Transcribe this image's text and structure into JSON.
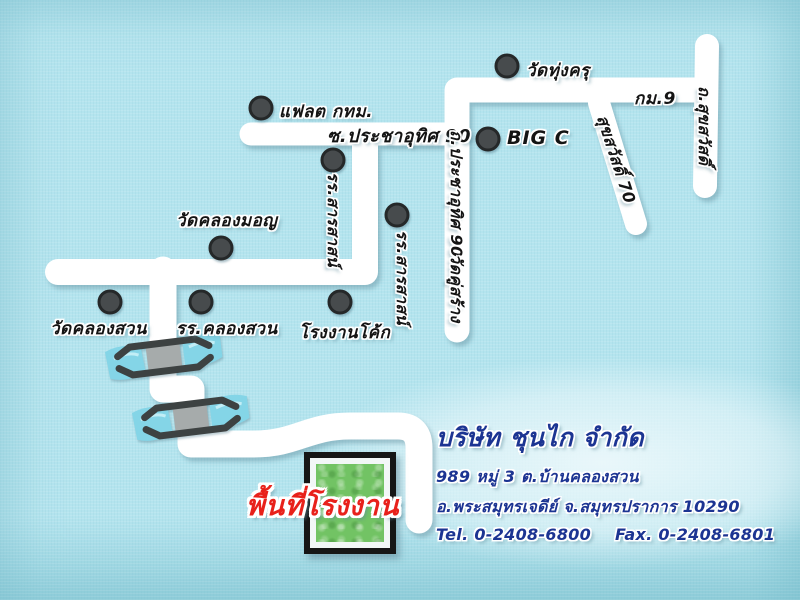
{
  "map": {
    "colors": {
      "background": "#b4e4ee",
      "road": "#ffffff",
      "dot": "#474b4d",
      "water": "#84d5e7",
      "factory_green": "#72c364",
      "factory_label_red": "#e8211b",
      "company_text_blue": "#1c3492"
    },
    "landmarks": [
      {
        "id": "flat-bangkok",
        "label": "แฟลต กทม."
      },
      {
        "id": "wat-thung-khru",
        "label": "วัดทุ่งครุ"
      },
      {
        "id": "big-c",
        "label": "BIG C"
      },
      {
        "id": "sarasas-school-west",
        "label": "รร.สารสาสน์"
      },
      {
        "id": "sarasas-school-east",
        "label": "รร.สารสาสน์"
      },
      {
        "id": "wat-khlong-mon",
        "label": "วัดคลองมอญ"
      },
      {
        "id": "coke-factory",
        "label": "โรงงานโค้ก"
      },
      {
        "id": "wat-khlong-suan",
        "label": "วัดคลองสวน"
      },
      {
        "id": "khlong-suan-school",
        "label": "รร.คลองสวน"
      }
    ],
    "road_labels": [
      {
        "id": "soi-pracha-uthit-90",
        "label": "ซ.ประชาอุทิศ 90",
        "orientation": "horizontal"
      },
      {
        "id": "th-pracha-uthit-90",
        "label": "ถ.ประชาอุทิศ 90",
        "orientation": "vertical"
      },
      {
        "id": "wat-khu-sang",
        "label": "วัดคู่สร้าง",
        "orientation": "vertical"
      },
      {
        "id": "km-9",
        "label": "กม.9",
        "orientation": "horizontal"
      },
      {
        "id": "th-suksawat",
        "label": "ถ.สุขสวัสดิ์",
        "orientation": "vertical"
      },
      {
        "id": "suksawat-70",
        "label": "สุขสวัสดิ์ 70",
        "orientation": "diagonal"
      }
    ],
    "bridge_count": 2,
    "factory_area_label": "พื้นที่โรงงาน"
  },
  "company": {
    "name": "บริษัท ชุนไก จำกัด",
    "address_line1": "989 หมู่ 3 ต.บ้านคลองสวน",
    "address_line2": "อ.พระสมุทรเจดีย์ จ.สมุทรปราการ 10290",
    "tel": "Tel. 0-2408-6800",
    "fax": "Fax. 0-2408-6801"
  }
}
